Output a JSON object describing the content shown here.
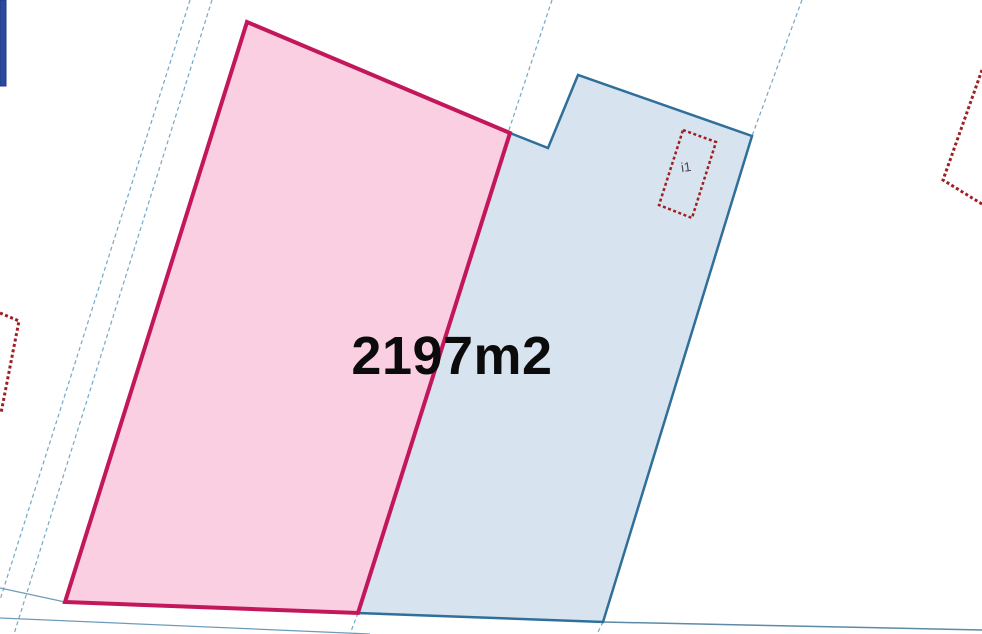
{
  "map": {
    "width": 982,
    "height": 634,
    "colors": {
      "background": "#ffffff",
      "parcel_pink_fill": "#f9cfe1",
      "parcel_pink_stroke": "#c2175b",
      "parcel_blue_fill": "#d7e3ef",
      "parcel_blue_stroke": "#2f6f99",
      "thin_boundary_line": "#74a8c6",
      "road_edge_line": "#5d8aa6",
      "building_outline": "#9e2023",
      "window_edge_panel": "#2b4a9c"
    },
    "area_label": {
      "text": "2197m2",
      "x": 452,
      "y": 356
    },
    "building_label": {
      "text": "i1",
      "x": 686,
      "y": 167
    },
    "rects": [
      {
        "name": "window-edge-panel",
        "x": 0,
        "y": 0,
        "w": 6,
        "h": 86,
        "fill": "#2b4a9c",
        "stroke": "#1d3a85"
      }
    ],
    "polylines": [
      {
        "name": "road-boundary-dashed-left-1",
        "points": "190,0 0,600",
        "color": "#74a8c6",
        "width": 1.2,
        "dash": "4 3"
      },
      {
        "name": "road-boundary-dashed-left-2",
        "points": "212,0 14,634",
        "color": "#74a8c6",
        "width": 1.2,
        "dash": "4 3"
      },
      {
        "name": "parcel-boundary-dashed-top-center",
        "points": "552,0 508,133",
        "color": "#74a8c6",
        "width": 1.2,
        "dash": "4 3"
      },
      {
        "name": "parcel-boundary-dashed-top-right",
        "points": "802,0 752,136",
        "color": "#74a8c6",
        "width": 1.2,
        "dash": "4 3"
      },
      {
        "name": "road-edge-bottom-left",
        "points": "0,588 65,602",
        "color": "#6d9cba",
        "width": 1.3
      },
      {
        "name": "road-edge-bottom-lower",
        "points": "0,618 370,634",
        "color": "#6d9cba",
        "width": 1.3
      },
      {
        "name": "road-edge-bottom-right",
        "points": "603,622 982,630",
        "color": "#5d8aa6",
        "width": 1.5
      },
      {
        "name": "boundary-stub-below-pink-corner",
        "points": "358,613 350,634",
        "color": "#74a8c6",
        "width": 1.2,
        "dash": "4 3"
      },
      {
        "name": "boundary-stub-below-blue-corner",
        "points": "603,622 597,634",
        "color": "#74a8c6",
        "width": 1.2,
        "dash": "4 3"
      },
      {
        "name": "building-outline-partial-left",
        "points": "0,313 19,321 1,413",
        "color": "#9e2023",
        "width": 3,
        "dash": "3 2.5"
      },
      {
        "name": "building-outline-partial-top-right",
        "points": "982,70 943,180 982,204",
        "color": "#9e2023",
        "width": 3,
        "dash": "3 2.5"
      }
    ],
    "polygons": [
      {
        "name": "parcel-selected-blue",
        "points": "510,133 548,148 578,75 752,136 603,622 358,613",
        "fill": "#d7e3ef",
        "stroke": "#2f6f99",
        "stroke_width": 2.5
      },
      {
        "name": "parcel-highlighted-pink",
        "points": "247,22 510,133 358,613 65,602",
        "fill": "#f9cfe1",
        "stroke": "#c2175b",
        "stroke_width": 4
      },
      {
        "name": "building-outline-i1",
        "points": "683,130 716,142 692,218 659,205",
        "fill": "none",
        "stroke": "#9e2023",
        "stroke_width": 2.5,
        "dash": "3 2.5"
      }
    ]
  }
}
